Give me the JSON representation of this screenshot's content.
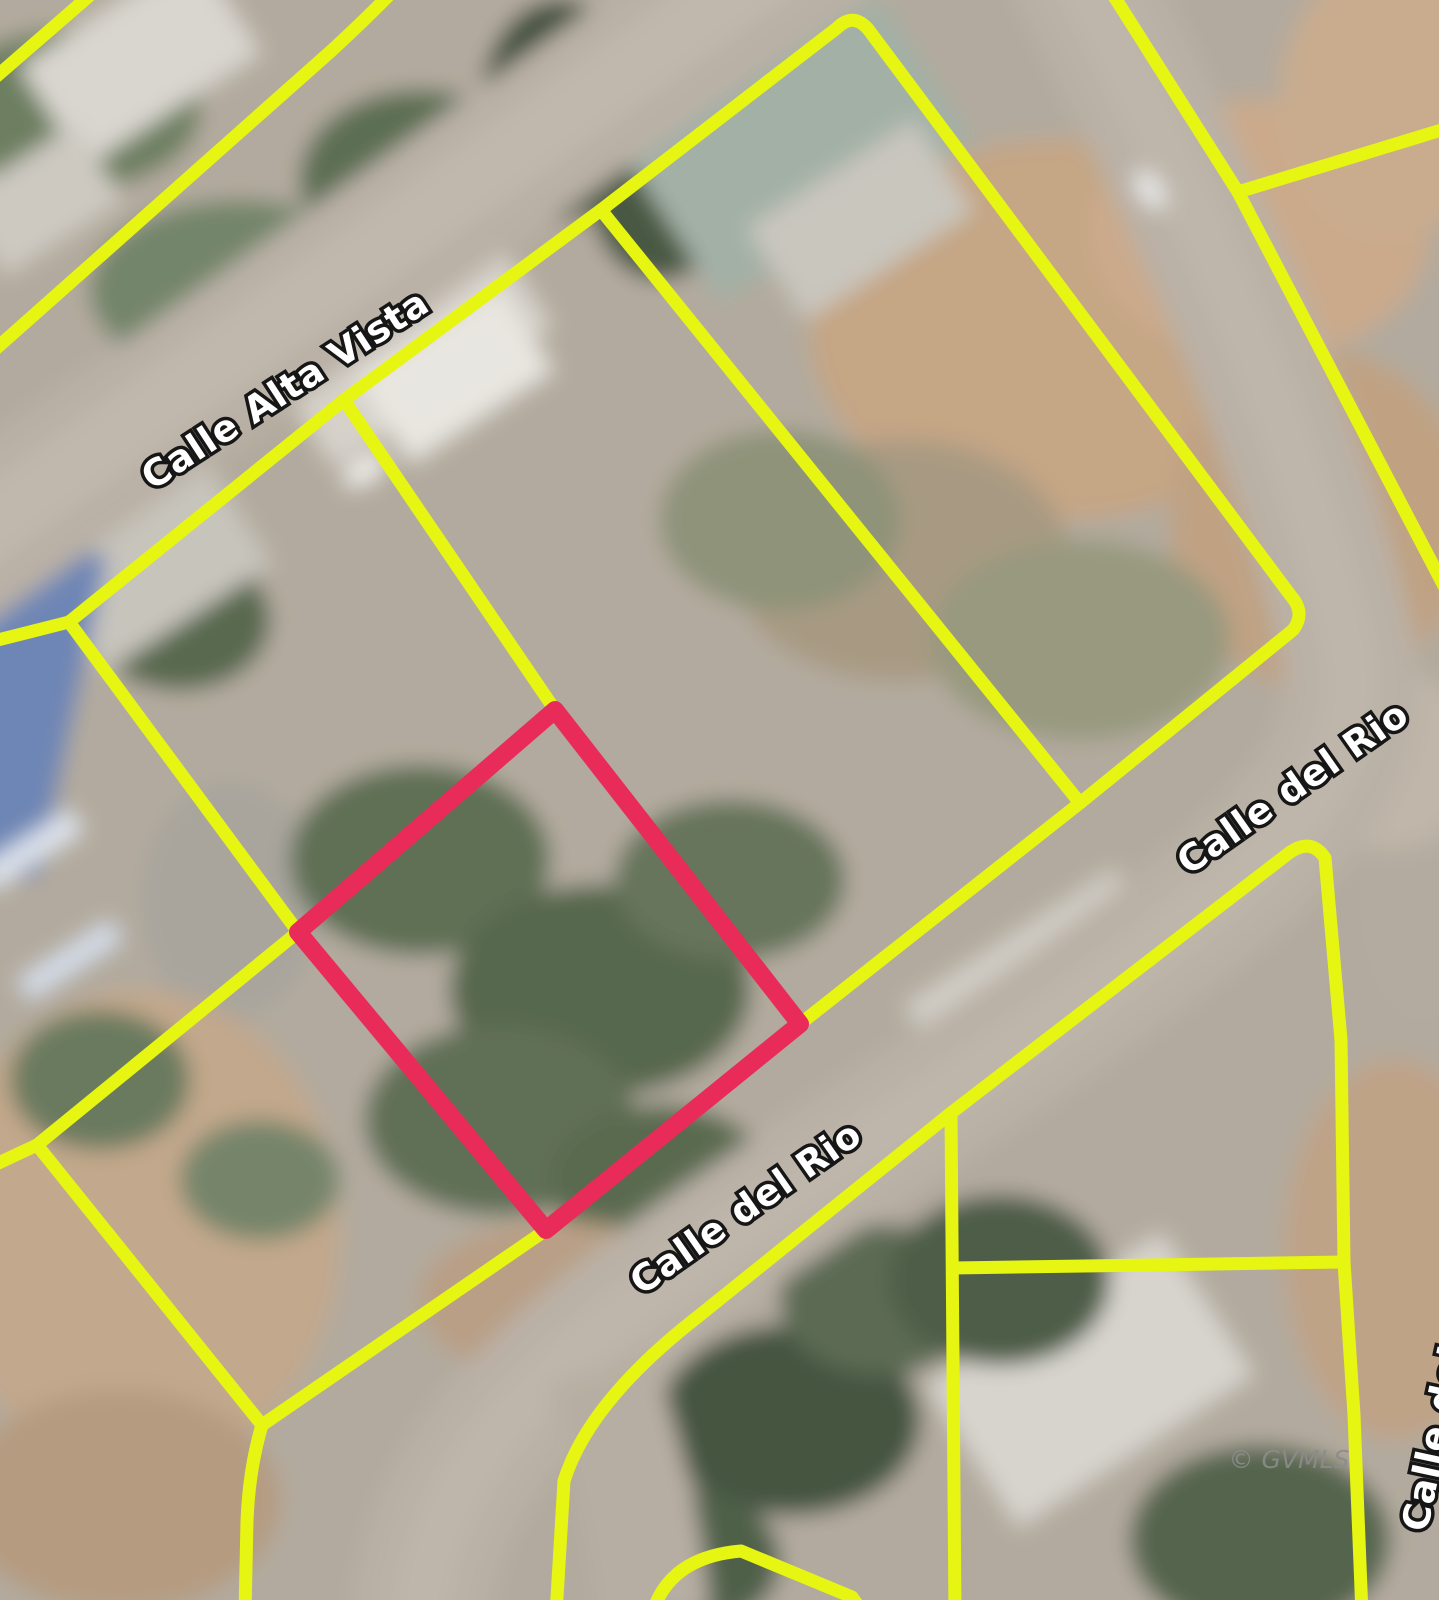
{
  "map": {
    "street_labels": {
      "alta_vista": "Calle Alta Vista",
      "del_rio": "Calle del Rio"
    },
    "watermark": "© GVMLS",
    "colors": {
      "parcel_outline": "#e7f513",
      "subject_parcel": "#e92b59",
      "label_fill": "#ffffff",
      "label_outline": "#161616",
      "watermark": "#8c8c8c"
    }
  }
}
